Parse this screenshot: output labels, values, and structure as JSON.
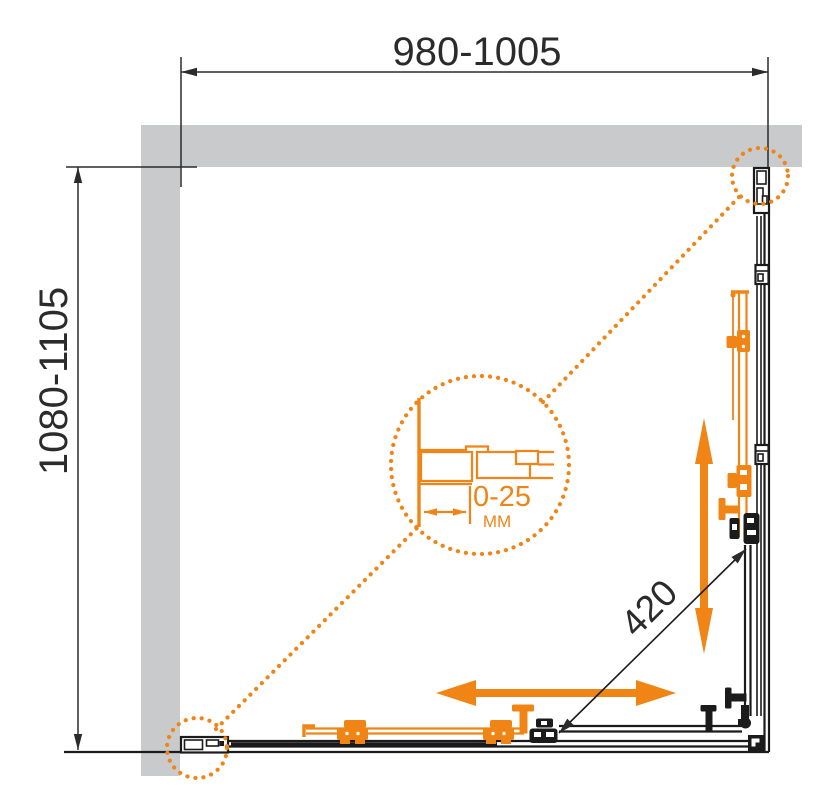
{
  "drawing": {
    "type": "technical-plan-diagram",
    "subject": "corner shower enclosure plan view with sliding doors",
    "dimensions": {
      "width_label": "980-1005",
      "height_label": "1080-1105",
      "entry_label": "420",
      "adjust_label": "0-25",
      "adjust_unit": "MM"
    },
    "colors": {
      "accent": "#F08415",
      "wall": "#C9CACC",
      "line": "#1B1B1B",
      "dim": "#2B2B2B"
    }
  }
}
